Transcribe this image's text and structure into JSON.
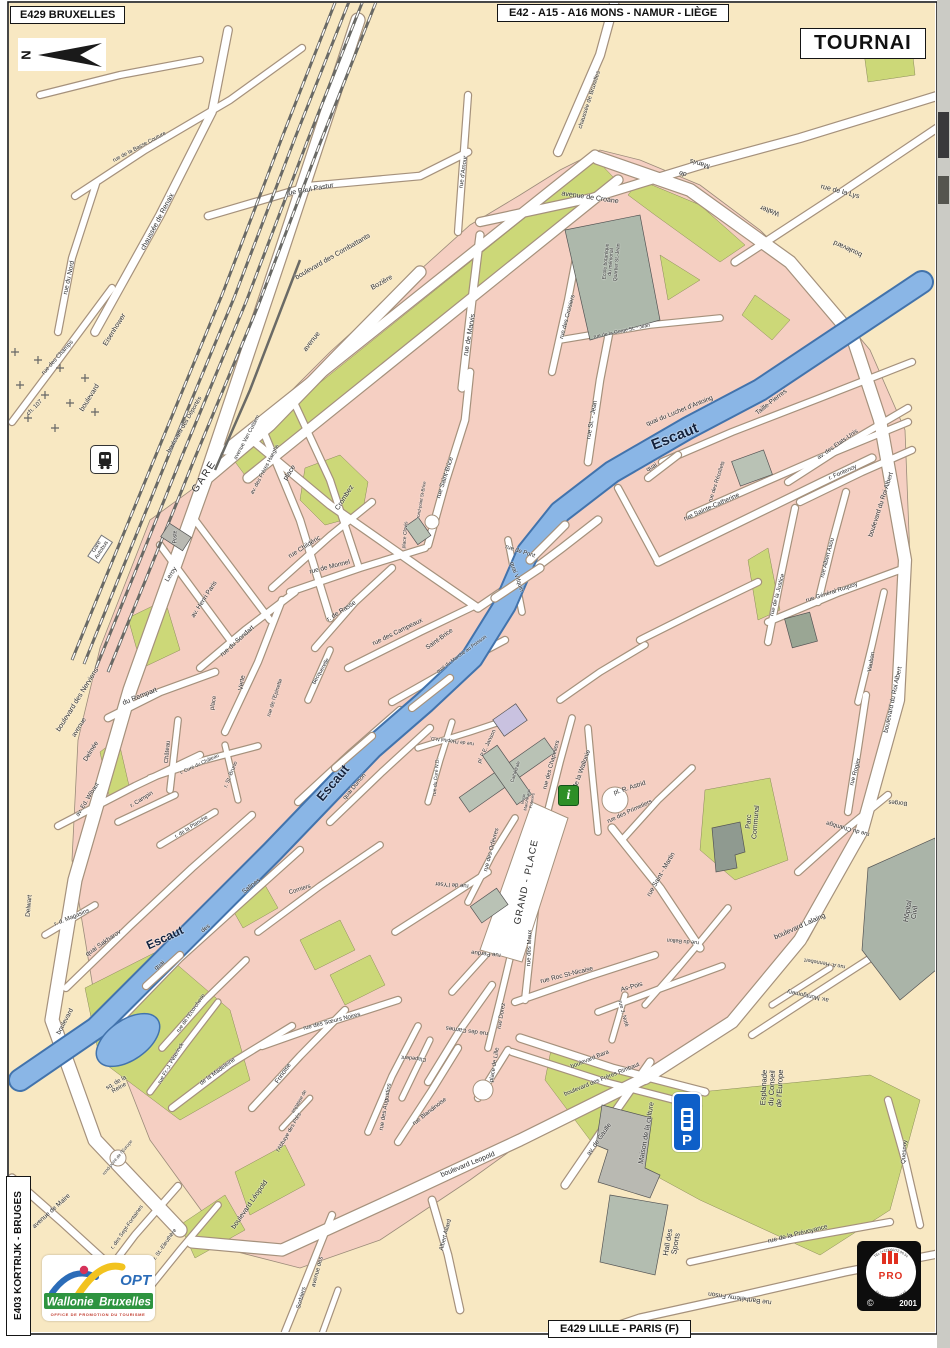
{
  "title": "TOURNAI",
  "signs": {
    "top_left": "E429 BRUXELLES",
    "top_center": "E42 - A15 - A16   MONS - NAMUR - LIÈGE",
    "city": "TOURNAI",
    "bottom": "E429 LILLE - PARIS (F)",
    "left_vertical": "E403 KORTRIJK - BRUGES"
  },
  "compass": {
    "letter": "N"
  },
  "river": {
    "name": "Escaut",
    "color": "#8ab6e6"
  },
  "colors": {
    "land": "#f8e8c2",
    "block": "#f5cfc2",
    "park": "#ccd878",
    "water": "#8ab6e6",
    "water_edge": "#4273ac",
    "road_casing": "#a5917c",
    "building": "#b9c2b5"
  },
  "logos": {
    "opt": {
      "acronym": "OPT",
      "region1": "Wallonie",
      "region2": "Bruxelles",
      "subtitle": "OFFICE DE PROMOTION DU TOURISME"
    },
    "pro": {
      "name": "PRO",
      "arc_top": "TEL (+32)050/72.06.54",
      "arc_bottom": "FAX (+32)050/72.07.52",
      "copyright": "©",
      "year": "2001"
    }
  },
  "icons": {
    "parking_label": "P",
    "info_label": "i"
  },
  "street_labels": [
    {
      "t": "chaussée de Bruxelles",
      "x": 590,
      "y": 100,
      "r": -72,
      "s": 6
    },
    {
      "t": "rue Paul Pastur",
      "x": 310,
      "y": 190,
      "r": -10,
      "s": 7
    },
    {
      "t": "avenue de Croane",
      "x": 590,
      "y": 198,
      "r": 8,
      "s": 7
    },
    {
      "t": "Marvis",
      "x": 700,
      "y": 163,
      "r": 197,
      "s": 7
    },
    {
      "t": "de",
      "x": 683,
      "y": 173,
      "r": 197,
      "s": 7
    },
    {
      "t": "Walter",
      "x": 770,
      "y": 210,
      "r": 200,
      "s": 7
    },
    {
      "t": "boulevard",
      "x": 848,
      "y": 248,
      "r": 205,
      "s": 7
    },
    {
      "t": "rue de la Lys",
      "x": 840,
      "y": 192,
      "r": 15,
      "s": 7
    },
    {
      "t": "rue de la Basse Couture",
      "x": 140,
      "y": 148,
      "r": -28,
      "s": 5.5
    },
    {
      "t": "chaussée de Renaix",
      "x": 158,
      "y": 222,
      "r": -62,
      "s": 7
    },
    {
      "t": "rue du Nord",
      "x": 70,
      "y": 278,
      "r": -78,
      "s": 6.5
    },
    {
      "t": "rue des Champs",
      "x": 58,
      "y": 358,
      "r": -48,
      "s": 6
    },
    {
      "t": "ch. 107",
      "x": 35,
      "y": 408,
      "r": -45,
      "s": 6
    },
    {
      "t": "Eisenhower",
      "x": 115,
      "y": 330,
      "r": -58,
      "s": 7
    },
    {
      "t": "boulevard",
      "x": 90,
      "y": 398,
      "r": -58,
      "s": 7
    },
    {
      "t": "boulevard des Déportés",
      "x": 185,
      "y": 425,
      "r": -60,
      "s": 6
    },
    {
      "t": "boulevard des  Combattants",
      "x": 333,
      "y": 257,
      "r": -30,
      "s": 7
    },
    {
      "t": "avenue",
      "x": 312,
      "y": 342,
      "r": -52,
      "s": 7
    },
    {
      "t": "Bozière",
      "x": 382,
      "y": 283,
      "r": -30,
      "s": 7
    },
    {
      "t": "rue d'Amour",
      "x": 464,
      "y": 172,
      "r": -82,
      "s": 6
    },
    {
      "t": "rue de Marvis",
      "x": 470,
      "y": 335,
      "r": -80,
      "s": 7
    },
    {
      "t": "rue des Croisiers",
      "x": 568,
      "y": 317,
      "r": -75,
      "s": 6
    },
    {
      "t": "rue de la Gorge St. - Jean",
      "x": 622,
      "y": 332,
      "r": -12,
      "s": 5
    },
    {
      "t": "GARE",
      "x": 205,
      "y": 477,
      "r": -57,
      "s": 10,
      "ls": 2
    },
    {
      "t": "place",
      "x": 290,
      "y": 473,
      "r": -57,
      "s": 7
    },
    {
      "t": "Crombez",
      "x": 345,
      "y": 498,
      "r": -57,
      "s": 7
    },
    {
      "t": "Poste",
      "x": 176,
      "y": 537,
      "r": -90,
      "s": 5
    },
    {
      "t": "Leroy",
      "x": 172,
      "y": 575,
      "r": -57,
      "s": 6.5
    },
    {
      "t": "av. Henri Paris",
      "x": 205,
      "y": 600,
      "r": -57,
      "s": 6.5
    },
    {
      "t": "avenue Van Cutsem",
      "x": 248,
      "y": 438,
      "r": -62,
      "s": 5.5
    },
    {
      "t": "av. des Frères Haeghe",
      "x": 266,
      "y": 470,
      "r": -62,
      "s": 5.5
    },
    {
      "t": "boulevard des  Nerviens",
      "x": 78,
      "y": 700,
      "r": -58,
      "s": 7
    },
    {
      "t": "avenue",
      "x": 80,
      "y": 728,
      "r": -58,
      "s": 6.5
    },
    {
      "t": "Delmée",
      "x": 92,
      "y": 752,
      "r": -58,
      "s": 6.5
    },
    {
      "t": "du Rempart",
      "x": 140,
      "y": 697,
      "r": -22,
      "s": 7
    },
    {
      "t": "rue du Sondart",
      "x": 238,
      "y": 642,
      "r": -42,
      "s": 6.5
    },
    {
      "t": "place",
      "x": 214,
      "y": 703,
      "r": -80,
      "s": 6
    },
    {
      "t": "Verte",
      "x": 243,
      "y": 683,
      "r": -80,
      "s": 6.5
    },
    {
      "t": "rue de l'Epinette",
      "x": 276,
      "y": 698,
      "r": -72,
      "s": 5.5
    },
    {
      "t": "Château",
      "x": 168,
      "y": 752,
      "r": -85,
      "s": 6
    },
    {
      "t": "r. Curé du Château",
      "x": 200,
      "y": 765,
      "r": -25,
      "s": 5
    },
    {
      "t": "r. St.-Bruno",
      "x": 232,
      "y": 775,
      "r": -68,
      "s": 5.5
    },
    {
      "t": "av. Ed. Wibaut",
      "x": 88,
      "y": 800,
      "r": -58,
      "s": 6
    },
    {
      "t": "r. Campin",
      "x": 142,
      "y": 800,
      "r": -32,
      "s": 6
    },
    {
      "t": "r. de la Planche",
      "x": 192,
      "y": 828,
      "r": -32,
      "s": 5.5
    },
    {
      "t": "rue Childéric",
      "x": 305,
      "y": 548,
      "r": -32,
      "s": 6.5
    },
    {
      "t": "rue  de  Monnel",
      "x": 330,
      "y": 568,
      "r": -14,
      "s": 6.5
    },
    {
      "t": "r. de Rasse",
      "x": 342,
      "y": 612,
      "r": -32,
      "s": 6.5
    },
    {
      "t": "rue des Campeaux",
      "x": 398,
      "y": 633,
      "r": -26,
      "s": 6.5
    },
    {
      "t": "Saint-Brice",
      "x": 440,
      "y": 640,
      "r": -36,
      "s": 6.5
    },
    {
      "t": "rue Saint-Brice",
      "x": 446,
      "y": 478,
      "r": -72,
      "s": 6.5
    },
    {
      "t": "rond-point St-Brice",
      "x": 422,
      "y": 500,
      "r": -80,
      "s": 4.5
    },
    {
      "t": "rue de Pont",
      "x": 520,
      "y": 552,
      "r": 18,
      "s": 6
    },
    {
      "t": "quai Vifquin",
      "x": 516,
      "y": 577,
      "r": 70,
      "s": 6
    },
    {
      "t": "place Clovis",
      "x": 406,
      "y": 535,
      "r": -85,
      "s": 5
    },
    {
      "t": "quai du Marché au Poisson",
      "x": 462,
      "y": 655,
      "r": -36,
      "s": 5
    },
    {
      "t": "Becquerelle",
      "x": 322,
      "y": 672,
      "r": -60,
      "s": 5.5
    },
    {
      "t": "quai  Dumon",
      "x": 355,
      "y": 787,
      "r": -50,
      "s": 6
    },
    {
      "t": "Escaut",
      "x": 675,
      "y": 437,
      "r": -22,
      "s": 15,
      "w": "bold",
      "c": "#13233f"
    },
    {
      "t": "Escaut",
      "x": 333,
      "y": 783,
      "r": -50,
      "s": 13,
      "w": "bold",
      "c": "#13233f"
    },
    {
      "t": "Escaut",
      "x": 165,
      "y": 938,
      "r": -25,
      "s": 12,
      "w": "bold",
      "c": "#13233f"
    },
    {
      "t": "quai du Luchet d'Antoing",
      "x": 680,
      "y": 412,
      "r": -22,
      "s": 6.5
    },
    {
      "t": "quai",
      "x": 652,
      "y": 468,
      "r": -30,
      "s": 6
    },
    {
      "t": "Taille-Pierres",
      "x": 772,
      "y": 403,
      "r": -38,
      "s": 6.5
    },
    {
      "t": "rue  St. - Jean",
      "x": 593,
      "y": 420,
      "r": -80,
      "s": 6.5
    },
    {
      "t": "rue des Récollets",
      "x": 718,
      "y": 482,
      "r": -72,
      "s": 5.5
    },
    {
      "t": "rue Sainte-Catherine",
      "x": 712,
      "y": 508,
      "r": -24,
      "s": 6.5
    },
    {
      "t": "av. des Etats-Unis",
      "x": 838,
      "y": 445,
      "r": -35,
      "s": 6
    },
    {
      "t": "r. Fontenoy",
      "x": 843,
      "y": 473,
      "r": -24,
      "s": 6
    },
    {
      "t": "boulevard du Roi Albert",
      "x": 882,
      "y": 505,
      "r": -72,
      "s": 6.5
    },
    {
      "t": "boulevard du Roi Albert",
      "x": 894,
      "y": 700,
      "r": -78,
      "s": 6.5
    },
    {
      "t": "rue Albert Asou",
      "x": 828,
      "y": 558,
      "r": -75,
      "s": 6
    },
    {
      "t": "rue Général Ruquoy",
      "x": 832,
      "y": 593,
      "r": -18,
      "s": 6
    },
    {
      "t": "rue de la Justice",
      "x": 778,
      "y": 595,
      "r": -75,
      "s": 6
    },
    {
      "t": "rue Rogier",
      "x": 856,
      "y": 772,
      "r": -75,
      "s": 6
    },
    {
      "t": "Vauban",
      "x": 872,
      "y": 662,
      "r": -80,
      "s": 6
    },
    {
      "t": "rue du Chambge",
      "x": 848,
      "y": 828,
      "r": 195,
      "s": 6
    },
    {
      "t": "Borges",
      "x": 898,
      "y": 802,
      "r": 185,
      "s": 6
    },
    {
      "t": "boulevard Lalaing",
      "x": 800,
      "y": 927,
      "r": -24,
      "s": 7
    },
    {
      "t": "rue  Saint - Martin",
      "x": 662,
      "y": 875,
      "r": -60,
      "s": 6.5
    },
    {
      "t": "rue A. Hennebert",
      "x": 825,
      "y": 962,
      "r": 190,
      "s": 5.5
    },
    {
      "t": "av. Montgomery",
      "x": 808,
      "y": 995,
      "r": 192,
      "s": 6
    },
    {
      "t": "rue du Ballon",
      "x": 683,
      "y": 940,
      "r": 185,
      "s": 5.5
    },
    {
      "t": "pl. R. Astrid",
      "x": 630,
      "y": 789,
      "r": -18,
      "s": 6.5
    },
    {
      "t": "rue des Chapeliers",
      "x": 552,
      "y": 765,
      "r": -75,
      "s": 6
    },
    {
      "t": "r. de la  Wallonie",
      "x": 582,
      "y": 772,
      "r": -70,
      "s": 6.5
    },
    {
      "t": "rue des Primetiers",
      "x": 630,
      "y": 812,
      "r": -25,
      "s": 6
    },
    {
      "t": "pl. P.E. Janson",
      "x": 488,
      "y": 747,
      "r": -65,
      "s": 5.5
    },
    {
      "t": "rue du Curé N.D.",
      "x": 437,
      "y": 777,
      "r": -85,
      "s": 5
    },
    {
      "t": "rue de l'Hôpital N.D.",
      "x": 452,
      "y": 740,
      "r": 188,
      "s": 5
    },
    {
      "t": "rue des Orfèvres",
      "x": 492,
      "y": 850,
      "r": -75,
      "s": 6
    },
    {
      "t": "rue de l'Yser",
      "x": 452,
      "y": 884,
      "r": 184,
      "s": 6
    },
    {
      "t": "GRAND - PLACE",
      "x": 527,
      "y": 882,
      "r": -78,
      "s": 9.5,
      "ls": 1
    },
    {
      "t": "rue Perdue",
      "x": 486,
      "y": 953,
      "r": 186,
      "s": 6
    },
    {
      "t": "rue des Maux",
      "x": 530,
      "y": 948,
      "r": -88,
      "s": 6
    },
    {
      "t": "rue Dorez",
      "x": 502,
      "y": 1016,
      "r": -80,
      "s": 6
    },
    {
      "t": "rue Roc  St-Nicaise",
      "x": 567,
      "y": 976,
      "r": -14,
      "s": 6.5
    },
    {
      "t": "As-Pois",
      "x": 632,
      "y": 988,
      "r": -16,
      "s": 6.5
    },
    {
      "t": "rue J. Noté",
      "x": 622,
      "y": 1014,
      "r": 75,
      "s": 5.5
    },
    {
      "t": "rue des Carmes",
      "x": 467,
      "y": 1030,
      "r": 188,
      "s": 6
    },
    {
      "t": "place de  Lille",
      "x": 495,
      "y": 1065,
      "r": -80,
      "s": 6
    },
    {
      "t": "rue Blandinoise",
      "x": 430,
      "y": 1112,
      "r": -38,
      "s": 6
    },
    {
      "t": "rue des Augustins",
      "x": 386,
      "y": 1107,
      "r": -80,
      "s": 6
    },
    {
      "t": "Clapedent",
      "x": 414,
      "y": 1057,
      "r": 186,
      "s": 5.5
    },
    {
      "t": "Frinoise",
      "x": 284,
      "y": 1074,
      "r": -55,
      "s": 6.5
    },
    {
      "t": "impasse de",
      "x": 300,
      "y": 1102,
      "r": -60,
      "s": 5
    },
    {
      "t": "l'Abbaye des Prés",
      "x": 290,
      "y": 1133,
      "r": -60,
      "s": 5.5
    },
    {
      "t": "boulevard Leopold",
      "x": 468,
      "y": 1165,
      "r": -22,
      "s": 7
    },
    {
      "t": "boulevard Léopold",
      "x": 250,
      "y": 1205,
      "r": -55,
      "s": 7
    },
    {
      "t": "Albert Allard",
      "x": 446,
      "y": 1235,
      "r": -75,
      "s": 6
    },
    {
      "t": "av. de Gaulle",
      "x": 600,
      "y": 1140,
      "r": -55,
      "s": 6.5
    },
    {
      "t": "boulevard Bara",
      "x": 590,
      "y": 1060,
      "r": -22,
      "s": 6
    },
    {
      "t": "boulevard des Frères Rimbaut",
      "x": 602,
      "y": 1080,
      "r": -22,
      "s": 6
    },
    {
      "t": "rue de la Prévoyance",
      "x": 798,
      "y": 1235,
      "r": -14,
      "s": 6.5
    },
    {
      "t": "rue Barthélemy Frison",
      "x": 740,
      "y": 1297,
      "r": 188,
      "s": 6.5
    },
    {
      "t": "Quesnoy",
      "x": 905,
      "y": 1152,
      "r": -85,
      "s": 6
    },
    {
      "t": "quai Sakharov",
      "x": 104,
      "y": 944,
      "r": -35,
      "s": 6.5
    },
    {
      "t": "r. d. Magasins",
      "x": 72,
      "y": 918,
      "r": -22,
      "s": 6
    },
    {
      "t": "quai",
      "x": 160,
      "y": 966,
      "r": -38,
      "s": 6
    },
    {
      "t": "des",
      "x": 206,
      "y": 929,
      "r": -38,
      "s": 6
    },
    {
      "t": "Salines",
      "x": 252,
      "y": 887,
      "r": -38,
      "s": 6.5
    },
    {
      "t": "Corniers",
      "x": 300,
      "y": 890,
      "r": -18,
      "s": 6
    },
    {
      "t": "rue de l'Ecorcherie",
      "x": 192,
      "y": 1014,
      "r": -55,
      "s": 5.5
    },
    {
      "t": "rue Fr.-J. Péterinck",
      "x": 172,
      "y": 1064,
      "r": -60,
      "s": 5.5
    },
    {
      "t": "de la Madeleine",
      "x": 218,
      "y": 1072,
      "r": -36,
      "s": 6
    },
    {
      "t": "rue des Sœurs Noires",
      "x": 332,
      "y": 1022,
      "r": -14,
      "s": 6
    },
    {
      "t": "Delwart",
      "x": 30,
      "y": 906,
      "r": -85,
      "s": 6.5
    },
    {
      "t": "boulevard",
      "x": 66,
      "y": 1022,
      "r": -62,
      "s": 6.5
    },
    {
      "t": "avenue de Maire",
      "x": 52,
      "y": 1212,
      "r": -42,
      "s": 6.5
    },
    {
      "t": "r. des Sept-Fontaines",
      "x": 128,
      "y": 1228,
      "r": -55,
      "s": 5.5
    },
    {
      "t": "r. St.-Eleuthère",
      "x": 166,
      "y": 1245,
      "r": -55,
      "s": 5.5
    },
    {
      "t": "rond-point de l'Europe",
      "x": 118,
      "y": 1158,
      "r": -50,
      "s": 4.5
    },
    {
      "t": "avenue des",
      "x": 318,
      "y": 1272,
      "r": -75,
      "s": 6
    },
    {
      "t": "Sorbiers",
      "x": 302,
      "y": 1298,
      "r": -75,
      "s": 6
    }
  ],
  "landmark_labels": [
    {
      "lines": [
        "Ecole botanique",
        "du mémorial",
        "Quartier St.-Jean"
      ],
      "x": 612,
      "y": 262,
      "r": -85,
      "s": 5
    },
    {
      "lines": [
        "Gare",
        "Autobus"
      ],
      "x": 100,
      "y": 549,
      "r": -57,
      "s": 5.5,
      "box": true
    },
    {
      "lines": [
        "Esplanade",
        "du Conseil",
        "de l'Europe"
      ],
      "x": 772,
      "y": 1088,
      "r": -87,
      "s": 7.5
    },
    {
      "lines": [
        "Hall des",
        "Sports"
      ],
      "x": 672,
      "y": 1243,
      "r": -80,
      "s": 7.5
    },
    {
      "lines": [
        "Parc",
        "Communal"
      ],
      "x": 753,
      "y": 822,
      "r": -85,
      "s": 7
    },
    {
      "lines": [
        "Hôpital",
        "Civil"
      ],
      "x": 912,
      "y": 912,
      "r": -80,
      "s": 7
    },
    {
      "lines": [
        "Vieux",
        "Marché aux",
        "Poteries"
      ],
      "x": 528,
      "y": 800,
      "r": -80,
      "s": 4.2
    },
    {
      "lines": [
        "Maison de la culture"
      ],
      "x": 647,
      "y": 1133,
      "r": -80,
      "s": 7
    },
    {
      "lines": [
        "sq. de la",
        "Reine"
      ],
      "x": 118,
      "y": 1086,
      "r": -30,
      "s": 6
    },
    {
      "lines": [
        "Cathédrale"
      ],
      "x": 516,
      "y": 772,
      "r": -72,
      "s": 4.5
    }
  ]
}
